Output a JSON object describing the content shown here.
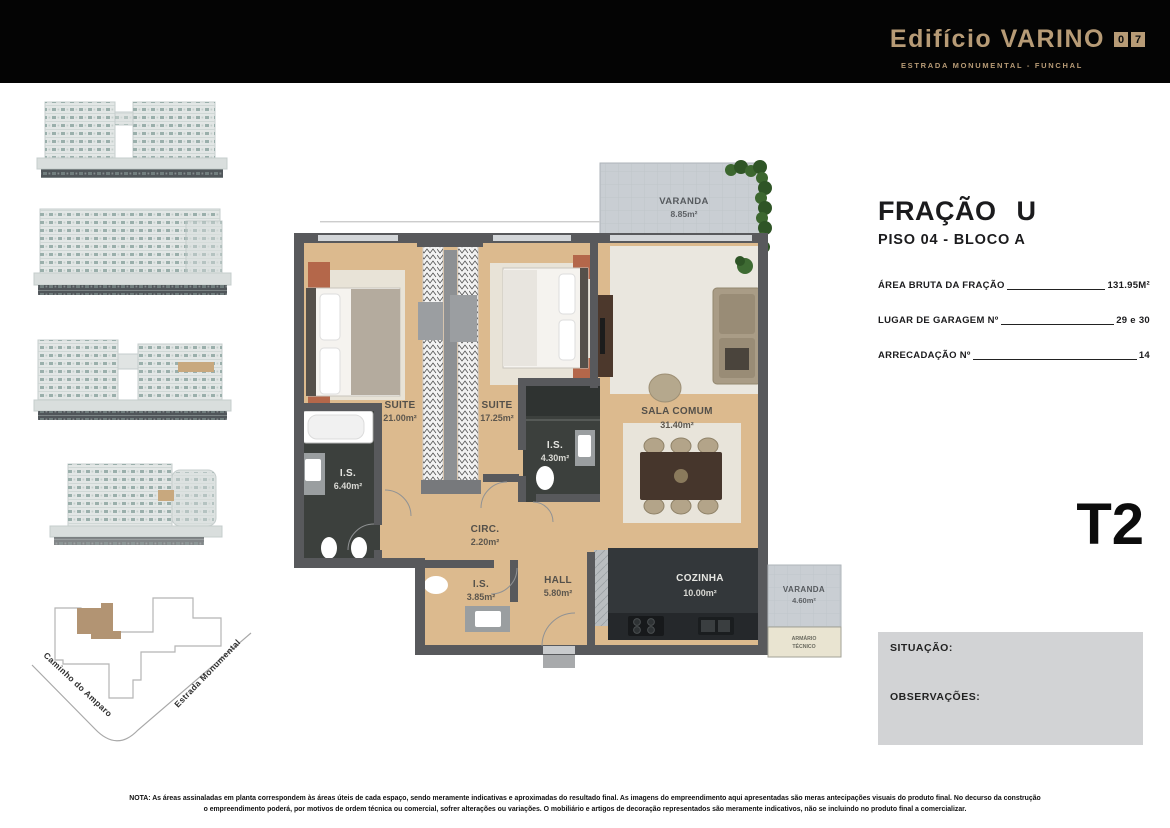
{
  "header": {
    "brand": "Edifício VARINO",
    "unit_box_digits": [
      "0",
      "7"
    ],
    "subtitle": "ESTRADA MONUMENTAL - FUNCHAL"
  },
  "panel": {
    "fraction_title": "FRAÇÃO U",
    "floor_block": "PISO 04 - BLOCO A",
    "rows": [
      {
        "label": "ÁREA BRUTA DA FRAÇÃO",
        "value": "131.95M²"
      },
      {
        "label": "LUGAR DE GARAGEM Nº",
        "value": "29 e 30"
      },
      {
        "label": "ARRECADAÇÃO Nº",
        "value": "14"
      }
    ],
    "typology": "T2",
    "situation_label": "SITUAÇÃO:",
    "observations_label": "OBSERVAÇÕES:"
  },
  "plan": {
    "rooms": [
      {
        "name": "VARANDA",
        "area": "8.85m²"
      },
      {
        "name": "SUITE",
        "area": "21.00m²"
      },
      {
        "name": "SUITE",
        "area": "17.25m²"
      },
      {
        "name": "SALA COMUM",
        "area": "31.40m²"
      },
      {
        "name": "I.S.",
        "area": "6.40m²"
      },
      {
        "name": "I.S.",
        "area": "4.30m²"
      },
      {
        "name": "CIRC.",
        "area": "2.20m²"
      },
      {
        "name": "I.S.",
        "area": "3.85m²"
      },
      {
        "name": "HALL",
        "area": "5.80m²"
      },
      {
        "name": "COZINHA",
        "area": "10.00m²"
      },
      {
        "name": "VARANDA",
        "area": "4.60m²"
      }
    ],
    "armario_line1": "ARMÁRIO",
    "armario_line2": "TÉCNICO"
  },
  "siteplan": {
    "street_left": "Caminho do Amparo",
    "street_right": "Estrada Monumental"
  },
  "footer": {
    "note_line1": "NOTA: As áreas assinaladas em planta correspondem às áreas úteis de cada espaço, sendo meramente indicativas e aproximadas do resultado final.  As imagens do empreendimento aqui apresentadas são meras antecipações visuais do produto final. No decurso da construção",
    "note_line2": "o empreendimento poderá, por motivos de ordem técnica ou comercial, sofrer alterações ou variações. O mobiliário e artigos de decoração representados são meramente indicativos, não se incluindo no produto final a comercializar."
  }
}
